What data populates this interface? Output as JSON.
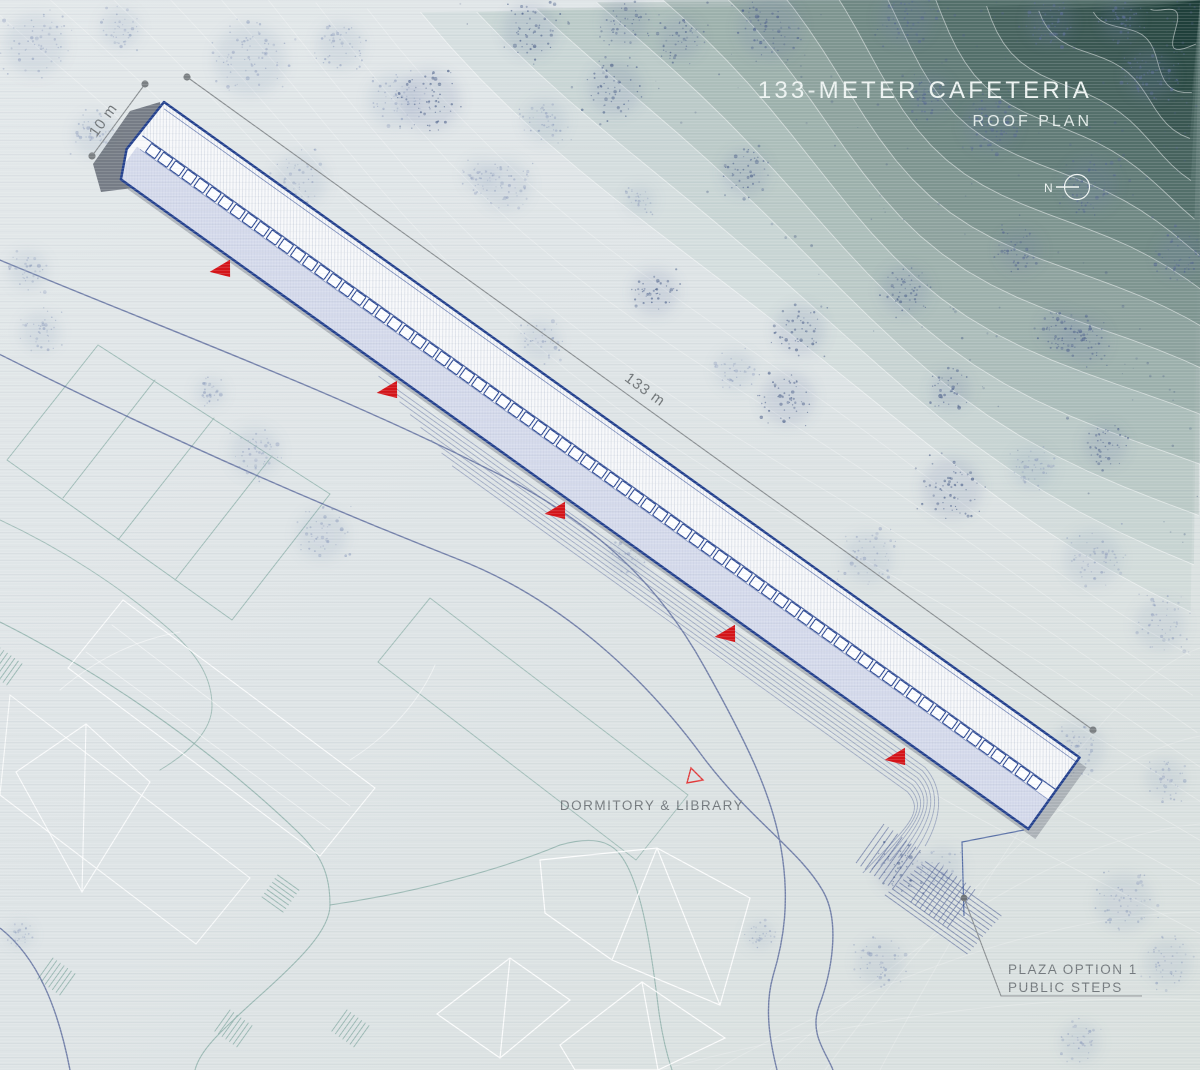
{
  "title": {
    "main": "133-METER CAFETERIA",
    "subtitle": "ROOF PLAN"
  },
  "north_indicator": {
    "label": "N"
  },
  "dimensions": {
    "building_width": "10 m",
    "building_length": "133 m"
  },
  "labels": {
    "adjacent_buildings": "DORMITORY & LIBRARY",
    "plaza_line1": "PLAZA OPTION 1",
    "plaza_line2": "PUBLIC STEPS"
  },
  "colors": {
    "accent_red": "#d41418",
    "building_outline": "#24418e",
    "roof_light": "#f7f8fa",
    "roof_shaded": "#d6dbec",
    "terrain_teal_dark": "#21413d",
    "terrain_teal_mid": "#6f9a90",
    "background": "#dfe5e7",
    "site_teal": "#93b4ae",
    "road_slate": "#5a699b",
    "label_gray": "#73797d",
    "title_white": "#edf3f1"
  }
}
